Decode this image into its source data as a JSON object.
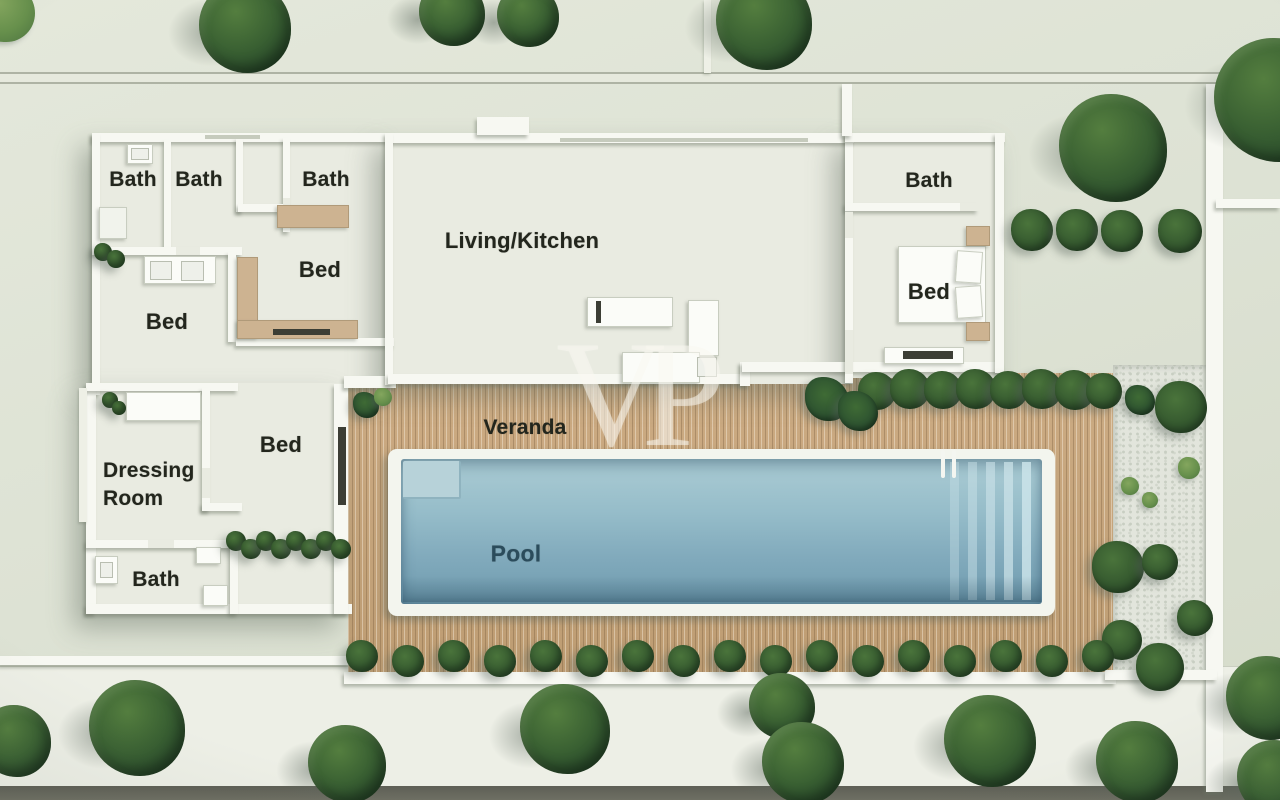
{
  "scene": {
    "type": "villa-floor-plan-3d-render",
    "watermark": "VP"
  },
  "labels": {
    "bath_top_1": "Bath",
    "bath_top_2": "Bath",
    "bath_top_3": "Bath",
    "bed_middle": "Bed",
    "bed_left": "Bed",
    "living_kitchen": "Living/Kitchen",
    "bath_right": "Bath",
    "bed_right": "Bed",
    "dressing_room": "Dressing Room",
    "bed_lower": "Bed",
    "bath_lower": "Bath",
    "veranda": "Veranda",
    "pool": "Pool"
  },
  "colors": {
    "ground": "#dde2d4",
    "path": "#edefe6",
    "road": "#6e6f63",
    "wall": "#f7f8f2",
    "floor": "#e9ebe1",
    "deck": "#c4a47c",
    "pebble": "#e2e5dc",
    "pool_water": "#8db6c4",
    "pool_frame": "#f3f5ee",
    "tan_furniture": "#cdb391",
    "tree_green": "#33552f",
    "label_text": "#23261d",
    "pool_label_text": "#2b4c5c"
  }
}
